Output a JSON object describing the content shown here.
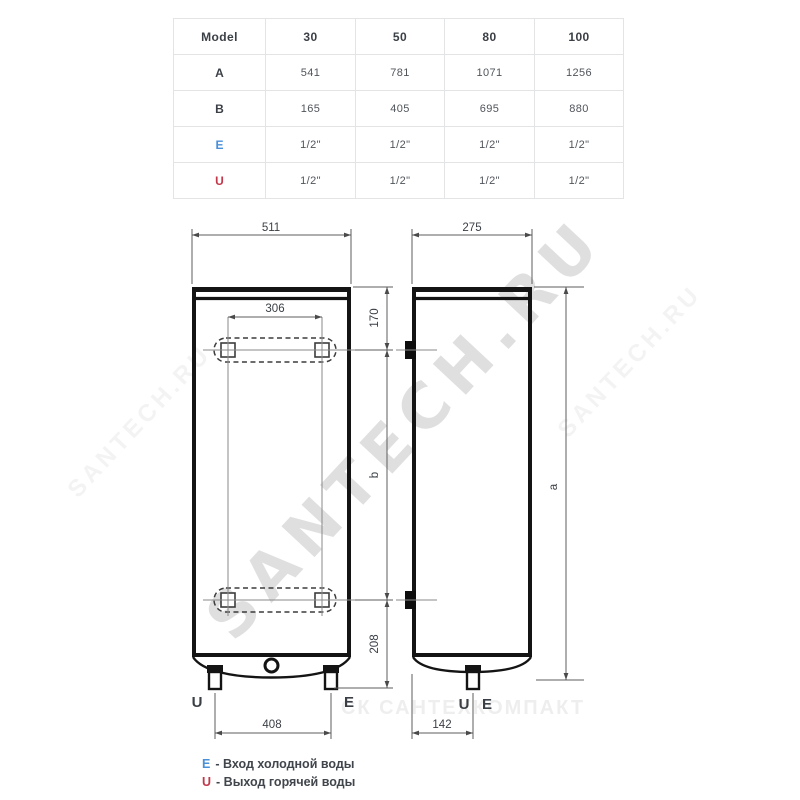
{
  "table": {
    "columns": [
      "Model",
      "30",
      "50",
      "80",
      "100"
    ],
    "rows": [
      {
        "label": "A",
        "values": [
          "541",
          "781",
          "1071",
          "1256"
        ]
      },
      {
        "label": "B",
        "values": [
          "165",
          "405",
          "695",
          "880"
        ]
      },
      {
        "label": "E",
        "values": [
          "1/2\"",
          "1/2\"",
          "1/2\"",
          "1/2\""
        ]
      },
      {
        "label": "U",
        "values": [
          "1/2\"",
          "1/2\"",
          "1/2\"",
          "1/2\""
        ]
      }
    ]
  },
  "diagram": {
    "front": {
      "width": "511",
      "bracket_span": "306",
      "top_to_bracket": "170",
      "bracket_spacing": "b",
      "bracket_to_feet": "208",
      "pipe_span": "408",
      "outlet": "U",
      "inlet": "E"
    },
    "side": {
      "depth": "275",
      "height": "a",
      "pipe_offset": "142",
      "outlet": "U",
      "inlet": "E"
    }
  },
  "legend": {
    "items": [
      {
        "symbol": "E",
        "text": "- Вход холодной воды"
      },
      {
        "symbol": "U",
        "text": "- Выход горячей воды"
      }
    ]
  },
  "watermarks": {
    "diagonal": "SANTECH.RU",
    "bottom": "СК САНТЕХКОМПАКТ"
  },
  "colors": {
    "inlet_blue": "#4a90d9",
    "outlet_red": "#c23749",
    "line_black": "#141414"
  }
}
